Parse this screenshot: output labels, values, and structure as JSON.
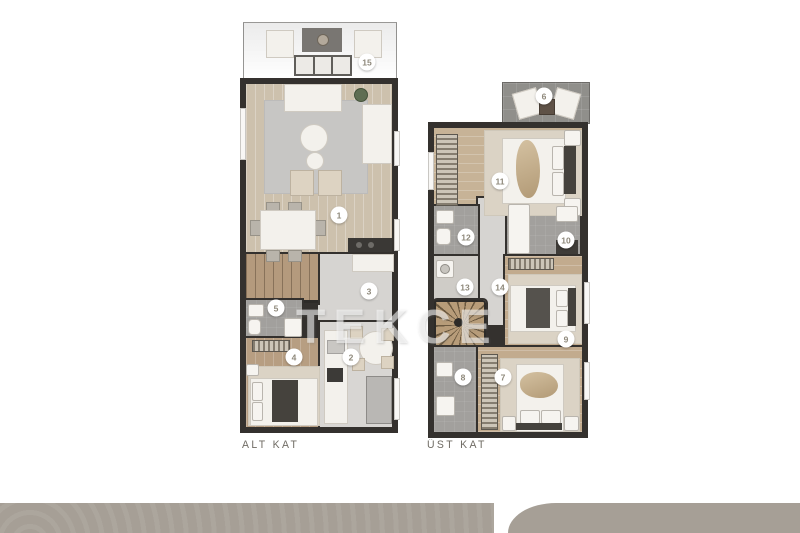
{
  "watermark": {
    "text": "TEKCE",
    "color": "rgba(255,255,255,0.55)"
  },
  "plans": {
    "alt_kat": {
      "label": "ALT KAT",
      "markers": [
        {
          "n": "1",
          "x": 339,
          "y": 215
        },
        {
          "n": "2",
          "x": 351,
          "y": 357
        },
        {
          "n": "3",
          "x": 369,
          "y": 291
        },
        {
          "n": "4",
          "x": 294,
          "y": 357
        },
        {
          "n": "5",
          "x": 276,
          "y": 308
        },
        {
          "n": "15",
          "x": 367,
          "y": 62
        }
      ]
    },
    "ust_kat": {
      "label": "ÜST KAT",
      "markers": [
        {
          "n": "6",
          "x": 544,
          "y": 96
        },
        {
          "n": "7",
          "x": 503,
          "y": 377
        },
        {
          "n": "8",
          "x": 463,
          "y": 377
        },
        {
          "n": "9",
          "x": 566,
          "y": 339
        },
        {
          "n": "10",
          "x": 566,
          "y": 240
        },
        {
          "n": "11",
          "x": 500,
          "y": 181
        },
        {
          "n": "12",
          "x": 466,
          "y": 237
        },
        {
          "n": "13",
          "x": 465,
          "y": 287
        },
        {
          "n": "14",
          "x": 500,
          "y": 287
        }
      ]
    }
  },
  "colors": {
    "wall": "#34312e",
    "wood_light": "#cdc1ad",
    "wood_warm": "#c7b397",
    "wood_mid": "#b79e82",
    "tile_gray": "#d6d4d1",
    "bath_gray": "#a2a09d",
    "terrace_gray": "#908f8b",
    "rug_gray": "#c7c6c4",
    "accent_bar": "#a69f96",
    "marker_text": "#8e887a",
    "label_text": "#6f6b63"
  }
}
